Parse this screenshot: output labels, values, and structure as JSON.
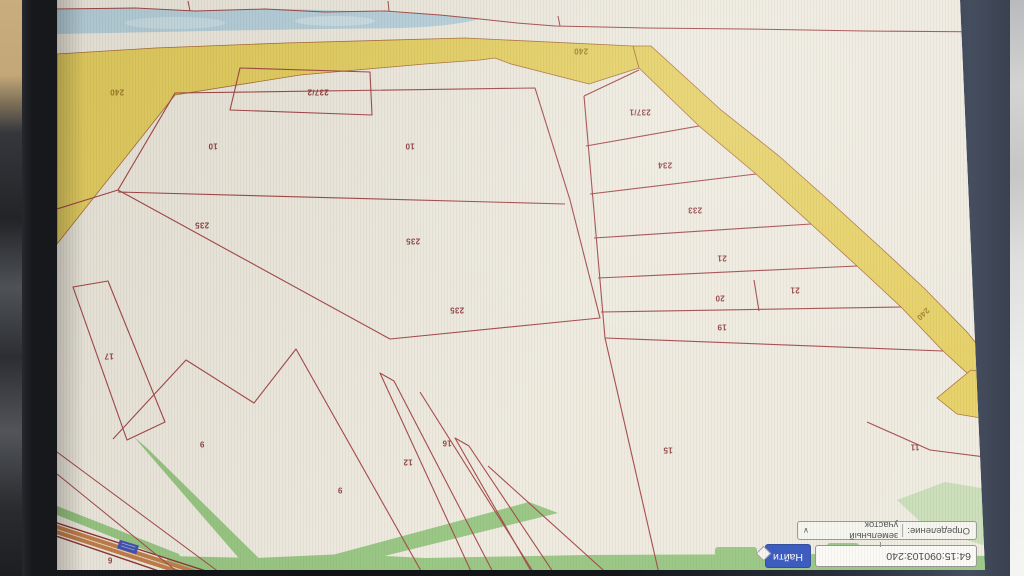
{
  "panel": {
    "search_value": "64:15:090103:240",
    "search_button_label": "Найти",
    "selector_label": "Определение:",
    "selector_value": "земельный участок",
    "chevron": "∨"
  },
  "map": {
    "labels": [
      {
        "t": "240",
        "x": 868,
        "y": 478,
        "c": "olive"
      },
      {
        "t": "240",
        "x": 404,
        "y": 519,
        "c": "olive"
      },
      {
        "t": "240",
        "x": 62,
        "y": 256,
        "c": "olive",
        "r": -45
      },
      {
        "t": "237/2",
        "x": 667,
        "y": 478,
        "c": "maroon"
      },
      {
        "t": "237/1",
        "x": 345,
        "y": 458,
        "c": "maroon"
      },
      {
        "t": "234",
        "x": 320,
        "y": 405,
        "c": "maroon"
      },
      {
        "t": "233",
        "x": 290,
        "y": 360,
        "c": "maroon"
      },
      {
        "t": "21",
        "x": 263,
        "y": 312,
        "c": "maroon"
      },
      {
        "t": "21",
        "x": 190,
        "y": 280,
        "c": "maroon"
      },
      {
        "t": "20",
        "x": 265,
        "y": 272,
        "c": "maroon"
      },
      {
        "t": "19",
        "x": 263,
        "y": 243,
        "c": "maroon"
      },
      {
        "t": "15",
        "x": 317,
        "y": 120,
        "c": "maroon"
      },
      {
        "t": "11",
        "x": 70,
        "y": 123,
        "c": "maroon"
      },
      {
        "t": "10",
        "x": 772,
        "y": 424,
        "c": "maroon"
      },
      {
        "t": "10",
        "x": 575,
        "y": 424,
        "c": "maroon"
      },
      {
        "t": "235",
        "x": 783,
        "y": 345,
        "c": "maroon"
      },
      {
        "t": "235",
        "x": 572,
        "y": 329,
        "c": "maroon"
      },
      {
        "t": "235",
        "x": 528,
        "y": 260,
        "c": "maroon"
      },
      {
        "t": "17",
        "x": 876,
        "y": 214,
        "c": "maroon"
      },
      {
        "t": "12",
        "x": 577,
        "y": 108,
        "c": "maroon"
      },
      {
        "t": "16",
        "x": 538,
        "y": 127,
        "c": "maroon"
      },
      {
        "t": "9",
        "x": 783,
        "y": 126,
        "c": "maroon"
      },
      {
        "t": "9",
        "x": 645,
        "y": 80,
        "c": "maroon"
      },
      {
        "t": "6",
        "x": 875,
        "y": 10,
        "c": "maroon"
      }
    ]
  },
  "colors": {
    "button_blue": "#2d50bb",
    "marker_blue": "#3b4db0",
    "parcel_outline_red": "#a14444",
    "road_edge_red": "#8c2f2f",
    "label_maroon": "#8e3c3c",
    "label_olive": "#9d7b25",
    "zone_yellow": "#e5cf5f",
    "zone_green": "#95c57f",
    "river_blue": "#b6d1dd",
    "map_cream": "#eeeadf"
  }
}
